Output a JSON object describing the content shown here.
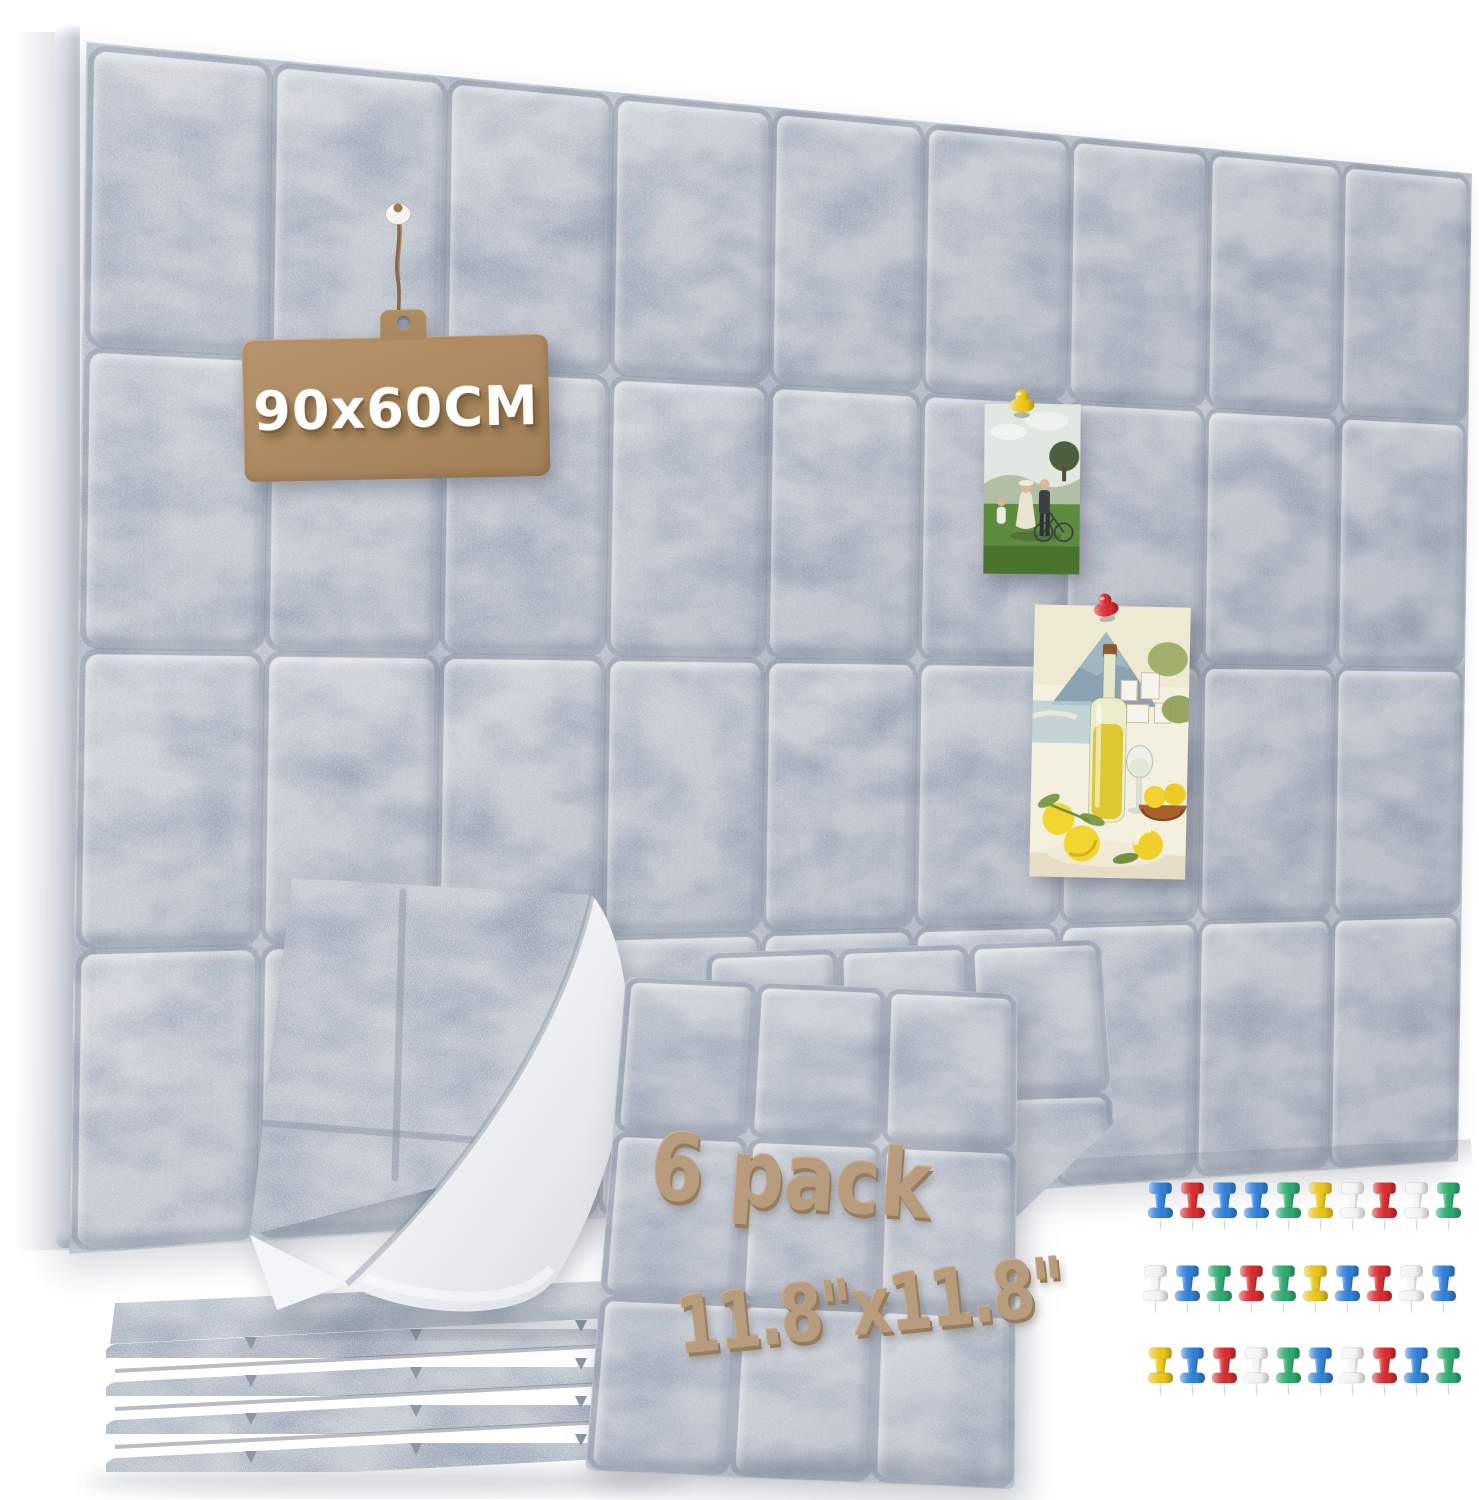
{
  "product": {
    "size_tag": "90x60CM",
    "pack_count": "6 pack",
    "panel_size": "11.8\"x11.8\""
  },
  "board": {
    "columns": 9,
    "rows": 4,
    "description": "grey felt pin board wall of square tiles"
  },
  "front_panel": {
    "grid": "3x3"
  },
  "colors": {
    "felt_base": "#c6cbd3",
    "felt_seam": "#727c8b",
    "kraft_tag": "#ae8b63",
    "tan_text": "#b89c7e",
    "wall": "#ffffff"
  },
  "pushpins": {
    "palette": {
      "blue": "#2e7ed8",
      "red": "#d7292c",
      "green": "#2aa96c",
      "yellow": "#e9c414",
      "white": "#f4f4f1"
    },
    "rows": [
      [
        "blue",
        "red",
        "blue",
        "blue",
        "green",
        "yellow",
        "white",
        "red",
        "white",
        "green"
      ],
      [
        "white",
        "blue",
        "green",
        "red",
        "green",
        "yellow",
        "blue",
        "red",
        "white",
        "blue"
      ],
      [
        "yellow",
        "blue",
        "red",
        "white",
        "green",
        "blue",
        "white",
        "red",
        "blue",
        "green"
      ]
    ]
  },
  "photos": [
    {
      "name": "family-bicycle-photo",
      "pin_color": "yellow"
    },
    {
      "name": "lemon-painting-photo",
      "pin_color": "red"
    }
  ],
  "tag": {
    "pin_color": "white"
  }
}
